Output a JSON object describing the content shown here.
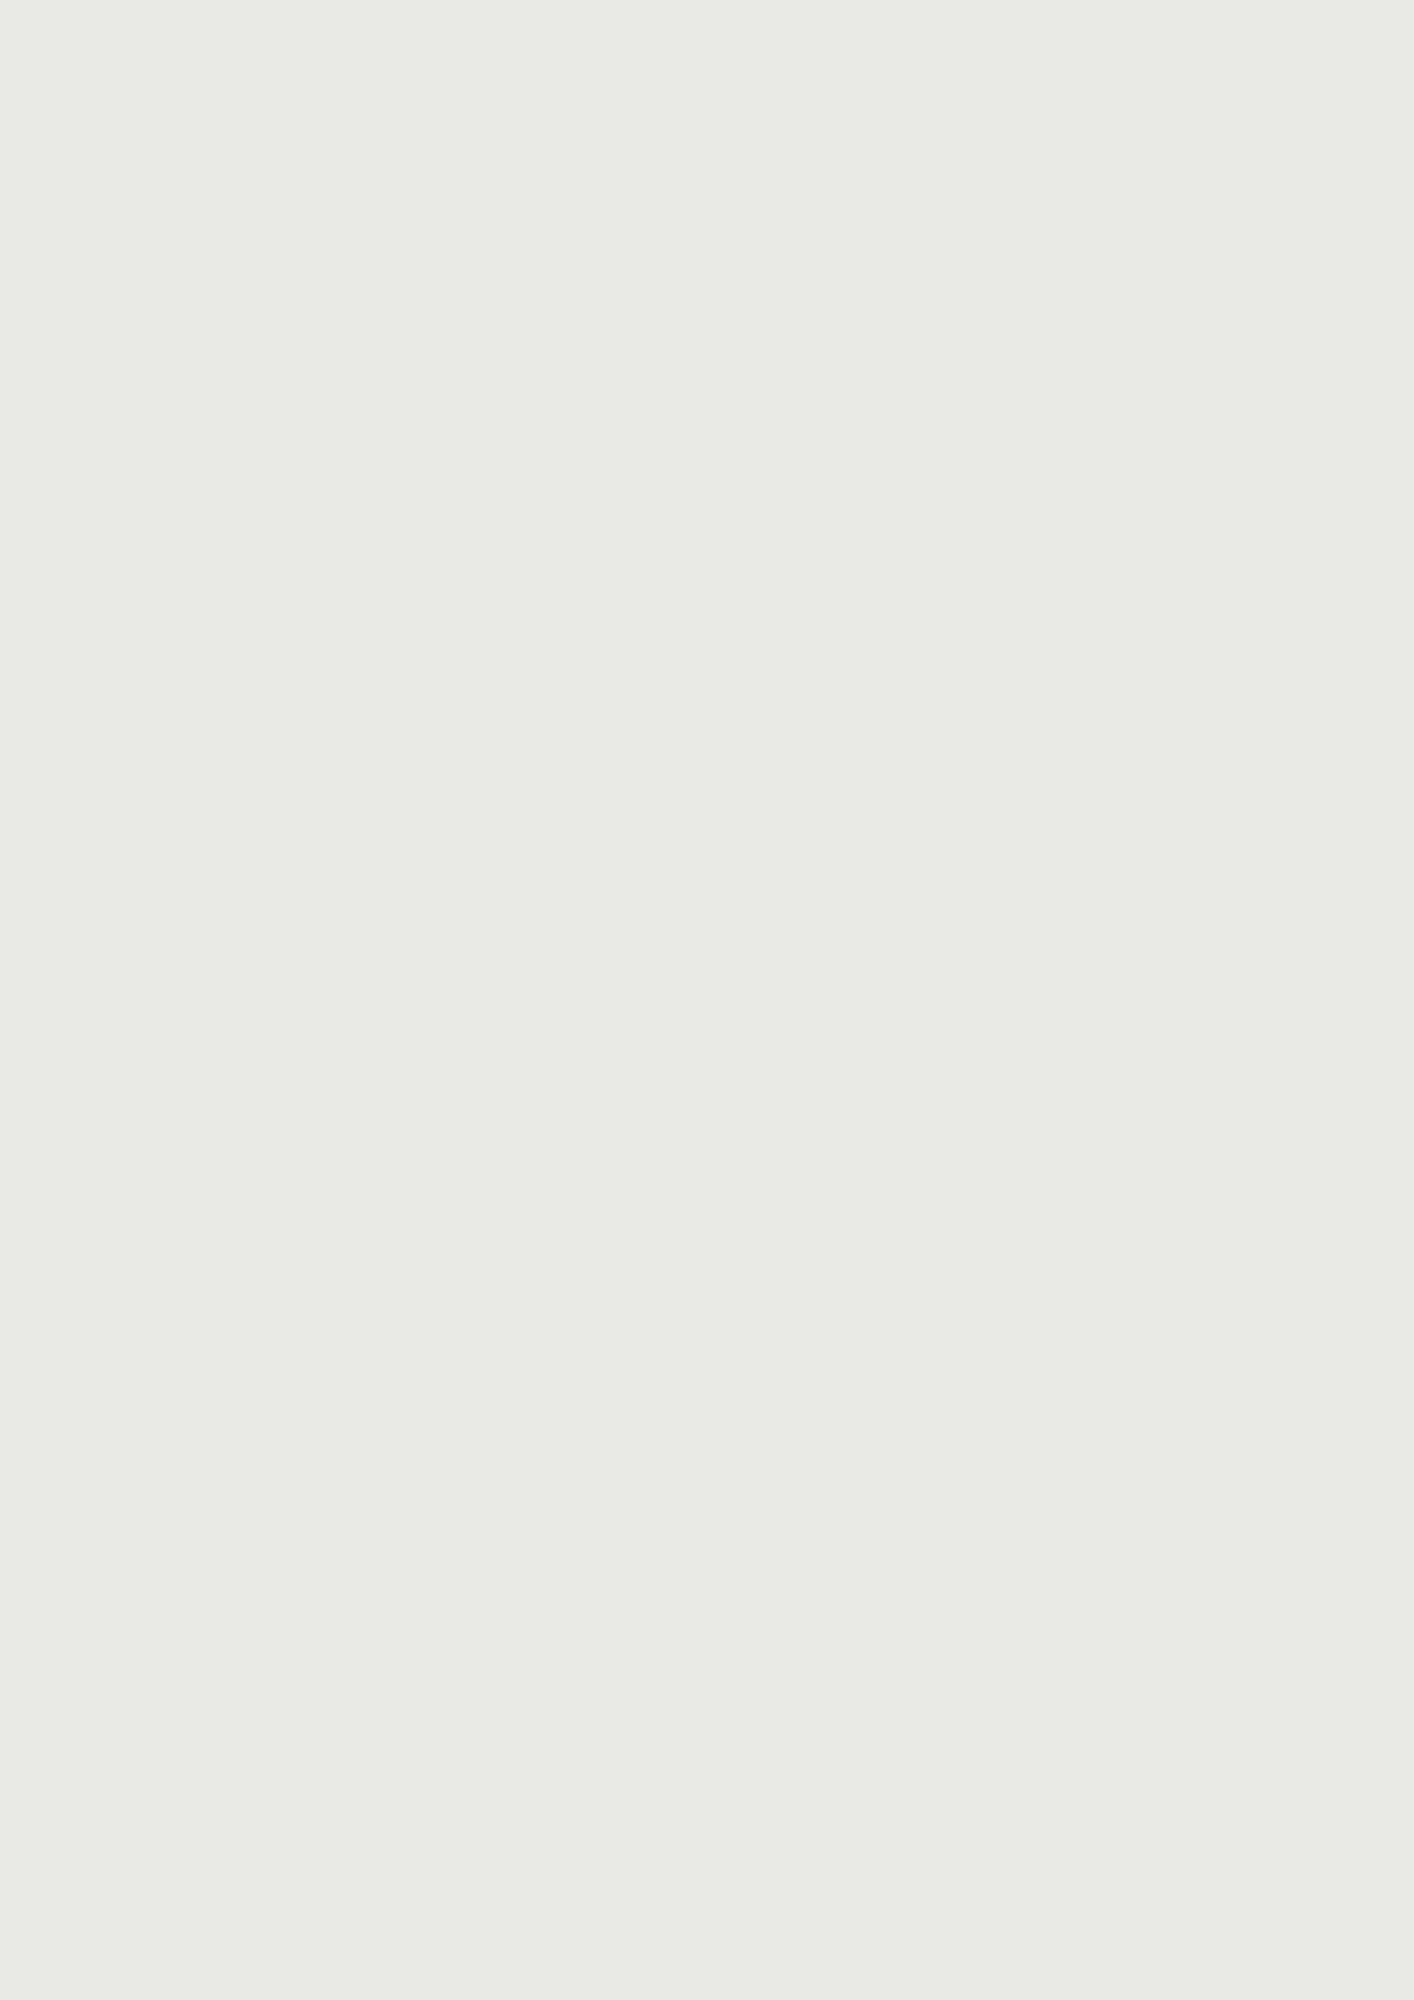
{
  "map": {
    "metro_logo": "M",
    "colors": {
      "accent_orange": "#d9822f",
      "metro_red": "#e2243c",
      "water": "#46535a",
      "forest": "#68775e",
      "tree_yellow": "#c9cf2b",
      "tree_sage": "#9dac78"
    },
    "metro_stations": [
      {
        "name": "orestad-arena-metro",
        "x": 1328,
        "y": 104
      },
      {
        "name": "vestamager-metro",
        "x": 1297,
        "y": 992
      }
    ],
    "labels": [
      {
        "t": "Byfælleden",
        "x": 527,
        "y": 126,
        "fs": 23,
        "c": "#ffffff",
        "b": 1
      },
      {
        "t": "Arenaen",
        "x": 893,
        "y": 47,
        "fs": 17,
        "c": "#8e8e8e"
      },
      {
        "t": "Ørestad Arena",
        "x": 1327,
        "y": 129,
        "fs": 9.5,
        "c": "#333333",
        "b": 1
      },
      {
        "t": "Arenakvarteret",
        "x": 858,
        "y": 388,
        "fs": 24,
        "c": "#2d2d2d",
        "b": 1
      },
      {
        "t": "Ørestadsrækkerne",
        "x": 797,
        "y": 670,
        "fs": 24,
        "c": "#2d2d2d",
        "b": 1
      },
      {
        "t": "Skovbåndet",
        "x": 575,
        "y": 742,
        "fs": 19,
        "c": "#2d2d2d",
        "b": 1
      },
      {
        "t": "Parkbåndet",
        "x": 801,
        "y": 789,
        "fs": 19,
        "c": "#2d2d2d",
        "b": 1
      },
      {
        "t": "Kanalbåndet",
        "x": 1049,
        "y": 713,
        "fs": 19,
        "c": "#2d2d2d",
        "b": 1
      },
      {
        "t": "Kalvebod Fælled",
        "x": 224,
        "y": 897,
        "fs": 27,
        "c": "#ffffff",
        "b": 1
      },
      {
        "t": "Hovedgaden",
        "x": 838,
        "y": 1010,
        "fs": 27,
        "c": "#2d2d2d",
        "b": 1
      },
      {
        "t": "Ørestadskarréerne",
        "x": 677,
        "y": 1233,
        "fs": 24,
        "c": "#2d2d2d",
        "b": 1
      },
      {
        "t": "8-tallet",
        "x": 1000,
        "y": 1311,
        "fs": 17,
        "c": "#6f6f6f",
        "b": 1
      },
      {
        "t": "\"Spidsen\"",
        "x": 537,
        "y": 1507,
        "fs": 24,
        "c": "#2d2d2d",
        "b": 1
      },
      {
        "t": "Vestamager Station",
        "x": 1301,
        "y": 1015,
        "fs": 9.5,
        "c": "#333333",
        "b": 1
      },
      {
        "t": "Eiler Billes Allé",
        "x": 893,
        "y": 503,
        "fs": 8,
        "c": "#8f8f8f"
      },
      {
        "t": "Asger Jorns Allé",
        "x": 1029,
        "y": 1010,
        "fs": 8.5,
        "c": "#9a9a9a"
      },
      {
        "t": "Richard Mortensens Vej",
        "x": 845,
        "y": 1145,
        "fs": 8,
        "c": "#8f8f8f",
        "r": 96
      },
      {
        "t": "Ørestads Boulevard",
        "x": 1277,
        "y": 760,
        "fs": 8,
        "c": "#9a9a9a",
        "r": 90
      },
      {
        "t": "Ørestads Boulevard",
        "x": 992,
        "y": 200,
        "fs": 8,
        "c": "#9a9a9a",
        "r": 88
      },
      {
        "t": "Else Alfelts Vej",
        "x": 592,
        "y": 1092,
        "fs": 8,
        "c": "#8f8f8f",
        "r": 94
      },
      {
        "t": "Kirsebærtræer",
        "x": 590,
        "y": 588,
        "fs": 8.5,
        "b": 1
      },
      {
        "t": "Æblelund",
        "x": 570,
        "y": 700,
        "fs": 8.5,
        "b": 1
      },
      {
        "t": "Byhaver",
        "x": 584,
        "y": 672,
        "fs": 8.5,
        "b": 1
      },
      {
        "t": "Kvarterslegeplads\nTarzanbane",
        "x": 586,
        "y": 771,
        "fs": 8.5,
        "b": 1
      },
      {
        "t": "picnic",
        "x": 595,
        "y": 800,
        "fs": 8.5,
        "b": 1
      },
      {
        "t": "Lærketræer",
        "x": 577,
        "y": 816,
        "fs": 8.5,
        "b": 1
      },
      {
        "t": "Byhaver",
        "x": 604,
        "y": 843,
        "fs": 8.5,
        "b": 1
      },
      {
        "t": "Løbehjulsbane\nKvarterslegeplads\nKlatrenet",
        "x": 822,
        "y": 730,
        "fs": 8.5,
        "b": 1
      },
      {
        "t": "Kvarterslegeplads\nKlatrenet",
        "x": 761,
        "y": 558,
        "fs": 8,
        "b": 1
      },
      {
        "t": "Multihal",
        "x": 501,
        "y": 943,
        "fs": 11,
        "b": 1
      },
      {
        "t": "Beboerhus",
        "x": 428,
        "y": 968,
        "fs": 10.5,
        "b": 1
      },
      {
        "t": "Udeservering",
        "x": 447,
        "y": 986,
        "fs": 8.5,
        "b": 1
      },
      {
        "t": "Danseplads",
        "x": 494,
        "y": 983,
        "fs": 8.5,
        "c": "#6b4423",
        "b": 1
      },
      {
        "t": "Byplads",
        "x": 482,
        "y": 999,
        "fs": 12,
        "b": 1
      },
      {
        "t": "Storskærmstyrede\naktiviteter",
        "x": 544,
        "y": 995,
        "fs": 8.5,
        "b": 1
      },
      {
        "t": "Butik/Erhverv",
        "x": 636,
        "y": 935,
        "fs": 9,
        "b": 1
      },
      {
        "t": "Restaurant",
        "x": 698,
        "y": 950,
        "fs": 8.5,
        "b": 1
      },
      {
        "t": "Dagligvarebutik",
        "x": 753,
        "y": 935,
        "fs": 11,
        "b": 1
      },
      {
        "t": "Udeservering",
        "x": 667,
        "y": 967,
        "fs": 8.5,
        "b": 1
      },
      {
        "t": "Bordtennis",
        "x": 662,
        "y": 977,
        "fs": 8.5,
        "b": 1
      },
      {
        "t": "Kæmpetrampolin",
        "x": 684,
        "y": 986,
        "fs": 8.5,
        "b": 1
      },
      {
        "t": "barrer",
        "x": 759,
        "y": 984,
        "fs": 8.5,
        "b": 1
      },
      {
        "t": "Restaurant",
        "x": 826,
        "y": 952,
        "fs": 8.5,
        "b": 1
      },
      {
        "t": "Butik/Erhverv",
        "x": 903,
        "y": 938,
        "fs": 9,
        "b": 1
      },
      {
        "t": "Aktivt P-hus",
        "x": 980,
        "y": 936,
        "fs": 12,
        "b": 1
      },
      {
        "t": "Klatrevæg",
        "x": 942,
        "y": 962,
        "fs": 8.5,
        "b": 1
      },
      {
        "t": "Streetbasket",
        "x": 933,
        "y": 974,
        "fs": 8.5,
        "b": 1
      },
      {
        "t": "Skating",
        "x": 988,
        "y": 959,
        "fs": 8.5,
        "b": 1
      },
      {
        "t": "Boulderclimbing",
        "x": 989,
        "y": 971,
        "fs": 8.5,
        "b": 1
      },
      {
        "t": "Vandleg",
        "x": 1050,
        "y": 963,
        "fs": 8.5,
        "b": 1
      },
      {
        "t": "Parkourbane",
        "x": 935,
        "y": 995,
        "fs": 8.5,
        "b": 1
      },
      {
        "t": "Vådområde",
        "x": 310,
        "y": 388,
        "fs": 9,
        "c": "#ffffff",
        "b": 1
      },
      {
        "t": "Gode kratvilkår",
        "x": 300,
        "y": 500,
        "fs": 9,
        "c": "#ffffff",
        "b": 1
      },
      {
        "t": "Vådområde",
        "x": 355,
        "y": 669,
        "fs": 9,
        "c": "#ffffff",
        "b": 1
      },
      {
        "t": "Legeplads",
        "x": 378,
        "y": 703,
        "fs": 9,
        "c": "#ffffff",
        "b": 1
      },
      {
        "t": "Gode krattræer",
        "x": 309,
        "y": 869,
        "fs": 9,
        "c": "#ffffff",
        "b": 1
      },
      {
        "t": "vild natur",
        "x": 328,
        "y": 920,
        "fs": 9,
        "c": "#ffffff",
        "b": 1
      },
      {
        "t": "Aktivitetsområde\nBeach volley",
        "x": 310,
        "y": 969,
        "fs": 9,
        "c": "#ffffff",
        "b": 1
      },
      {
        "t": "Enggræsser",
        "x": 246,
        "y": 979,
        "fs": 9,
        "c": "#ffffff",
        "b": 1
      },
      {
        "t": "Fremtidig supercykelsti til Sydhavnen",
        "x": 185,
        "y": 995,
        "fs": 8.5,
        "c": "#ffffff",
        "b": 1
      },
      {
        "t": "Krolf",
        "x": 280,
        "y": 1015,
        "fs": 9,
        "c": "#ffffff",
        "b": 1
      },
      {
        "t": "Petanque",
        "x": 373,
        "y": 982,
        "fs": 9,
        "c": "#ffffff",
        "b": 1
      },
      {
        "t": "Beach volley",
        "x": 352,
        "y": 1013,
        "fs": 9,
        "c": "#ffffff",
        "b": 1
      },
      {
        "t": "Aktivitetsområde",
        "x": 375,
        "y": 1030,
        "fs": 9,
        "c": "#ffffff",
        "b": 1
      },
      {
        "t": "Legeplads",
        "x": 341,
        "y": 1048,
        "fs": 9,
        "c": "#ffffff",
        "b": 1
      },
      {
        "t": "Bålplads",
        "x": 353,
        "y": 1062,
        "fs": 9,
        "c": "#ffffff",
        "b": 1
      },
      {
        "t": "Små hytter",
        "x": 343,
        "y": 1101,
        "fs": 9,
        "c": "#ffffff",
        "b": 1
      },
      {
        "t": "Vådområde",
        "x": 380,
        "y": 1135,
        "fs": 9,
        "c": "#ffffff",
        "b": 1
      },
      {
        "t": "Gode kratvilkår",
        "x": 270,
        "y": 1577,
        "fs": 9,
        "c": "#ffffff",
        "b": 1
      },
      {
        "t": "Vådområde",
        "x": 283,
        "y": 1610,
        "fs": 9,
        "c": "#ffffff",
        "b": 1
      },
      {
        "t": "Børnehave",
        "x": 476,
        "y": 1062,
        "fs": 12,
        "b": 1
      },
      {
        "t": "Ahorn",
        "x": 603,
        "y": 1054,
        "fs": 8.5,
        "b": 1
      },
      {
        "t": "Balancebane",
        "x": 625,
        "y": 1100,
        "fs": 8.5,
        "b": 1
      },
      {
        "t": "Blomme- og\nmirabellelund",
        "x": 631,
        "y": 1138,
        "fs": 8.5,
        "b": 1
      },
      {
        "t": "Egetræer",
        "x": 625,
        "y": 1177,
        "fs": 8.5,
        "b": 1
      },
      {
        "t": "Byhaver",
        "x": 643,
        "y": 1194,
        "fs": 8.5,
        "b": 1
      },
      {
        "t": "Kvarterslegeplads",
        "x": 820,
        "y": 1070,
        "fs": 8.5,
        "b": 1
      },
      {
        "t": "Crossfit/agility",
        "x": 829,
        "y": 1088,
        "fs": 8.5,
        "b": 1
      },
      {
        "t": "Pærelund",
        "x": 651,
        "y": 1270,
        "fs": 8.5,
        "b": 1
      },
      {
        "t": "\"Skovlegepladsen\"\nBalance, gynger og\nbuskelandskaber",
        "x": 653,
        "y": 1298,
        "fs": 8.5,
        "b": 1
      },
      {
        "t": "Kvarterslegeplads",
        "x": 888,
        "y": 1317,
        "fs": 8.5,
        "c": "#b5762a",
        "b": 1
      },
      {
        "t": "Eksisterende\nlegeplads",
        "x": 893,
        "y": 1496,
        "fs": 8.5,
        "b": 1
      },
      {
        "t": "Junglesti",
        "x": 624,
        "y": 1486,
        "fs": 8.5,
        "b": 1
      },
      {
        "t": "Æblelund",
        "x": 634,
        "y": 1543,
        "fs": 8.5,
        "b": 1
      },
      {
        "t": "Eksisterende\naktivitetsområde",
        "x": 881,
        "y": 1692,
        "fs": 8.5,
        "c": "#44543f",
        "b": 1
      },
      {
        "t": "Fyrretræer",
        "x": 604,
        "y": 1720,
        "fs": 8.5,
        "b": 1
      },
      {
        "t": "Fyrretræer",
        "x": 374,
        "y": 1560,
        "fs": 8.5,
        "b": 1
      },
      {
        "t": "Legeplads",
        "x": 380,
        "y": 1434,
        "fs": 8.5,
        "b": 1
      }
    ]
  }
}
